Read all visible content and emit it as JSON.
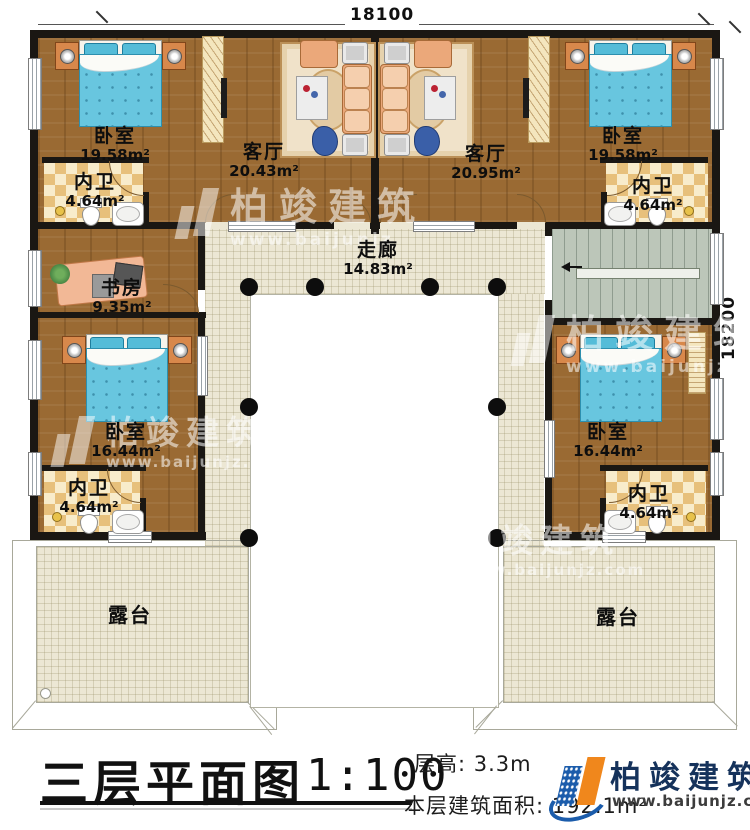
{
  "meta": {
    "dim_top": "18100",
    "dim_right": "18200"
  },
  "title": {
    "main": "三层平面图",
    "scale": "1:100",
    "floor_height": "层高: 3.3m",
    "floor_area": "本层建筑面积: 192.1m²"
  },
  "logo": {
    "name": "柏竣建筑",
    "url": "www.baijunjz.com"
  },
  "watermark": {
    "name": "柏竣建筑",
    "url": "www.baijunjz.com",
    "url_short": "www.baijunjz"
  },
  "rooms": {
    "bedroom_tl": {
      "name": "卧室",
      "area": "19.58m²"
    },
    "bath_tl": {
      "name": "内卫",
      "area": "4.64m²"
    },
    "living_left": {
      "name": "客厅",
      "area": "20.43m²"
    },
    "living_right": {
      "name": "客厅",
      "area": "20.95m²"
    },
    "bedroom_tr": {
      "name": "卧室",
      "area": "19.58m²"
    },
    "bath_tr": {
      "name": "内卫",
      "area": "4.64m²"
    },
    "corridor": {
      "name": "走廊",
      "area": "14.83m²"
    },
    "study": {
      "name": "书房",
      "area": "9.35m²"
    },
    "bedroom_ml": {
      "name": "卧室",
      "area": "16.44m²"
    },
    "bath_bl": {
      "name": "内卫",
      "area": "4.64m²"
    },
    "bedroom_mr": {
      "name": "卧室",
      "area": "16.44m²"
    },
    "bath_br": {
      "name": "内卫",
      "area": "4.64m²"
    },
    "terrace_left": {
      "name": "露台"
    },
    "terrace_right": {
      "name": "露台"
    }
  },
  "colors": {
    "wood": "#9a6a33",
    "tile": "#ece7d4",
    "bed": "#68c6df",
    "wall": "#1a1713",
    "logo_blue": "#1b5cab",
    "logo_orange": "#f0871c"
  }
}
